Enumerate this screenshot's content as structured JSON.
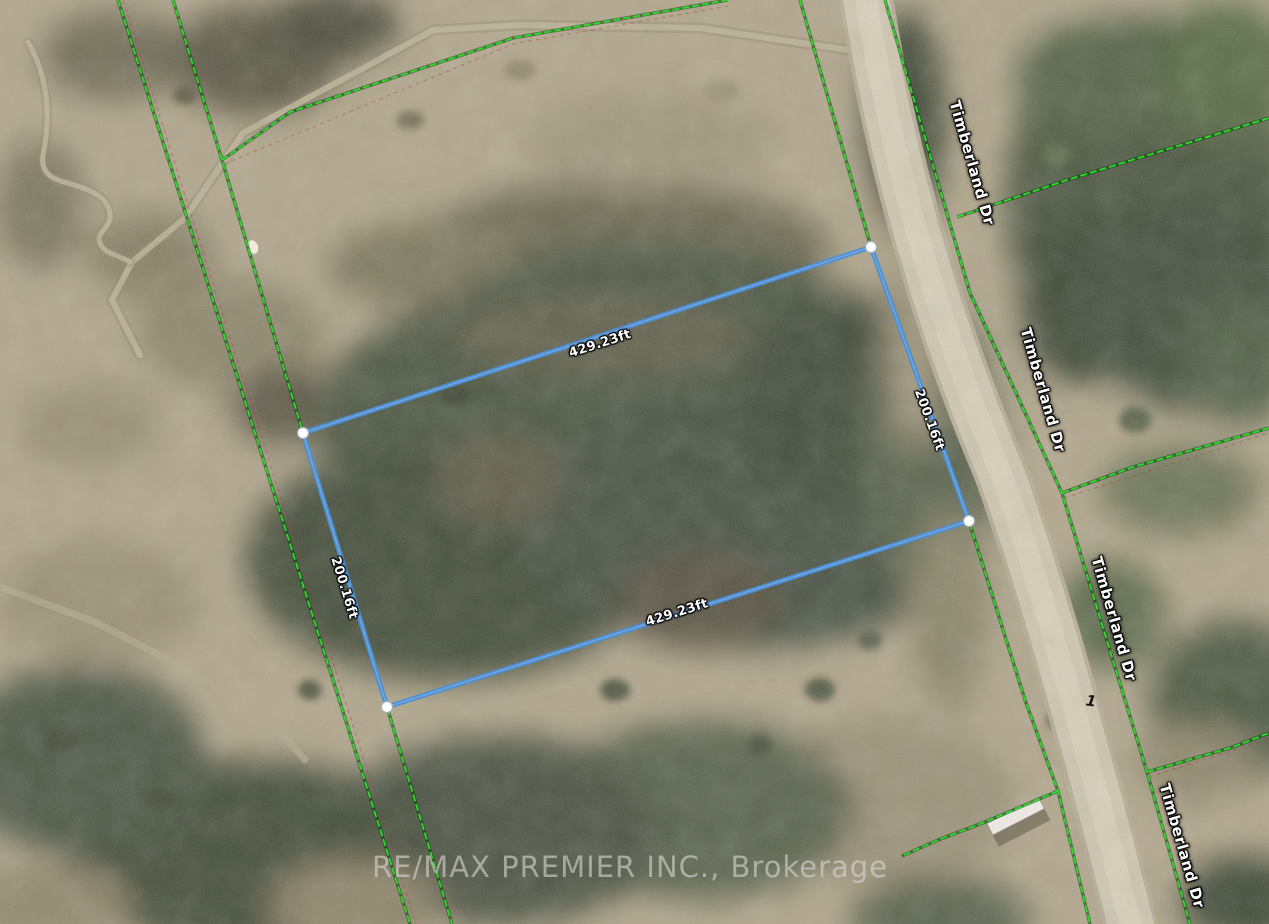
{
  "parcel": {
    "side_labels": {
      "top": "429.23ft",
      "right": "200.16ft",
      "bottom": "429.23ft",
      "left": "200.16ft"
    },
    "lot_number": "1",
    "outline_color": "#4d8fd8",
    "corner_marker_color": "#ffffff"
  },
  "road": {
    "name": "Timberland Dr",
    "labels": [
      "Timberland Dr",
      "Timberland Dr",
      "Timberland Dr",
      "Timberland Dr"
    ]
  },
  "boundaries": {
    "line_color": "#2ae02a"
  },
  "watermark": {
    "text": "RE/MAX PREMIER INC., Brokerage"
  }
}
